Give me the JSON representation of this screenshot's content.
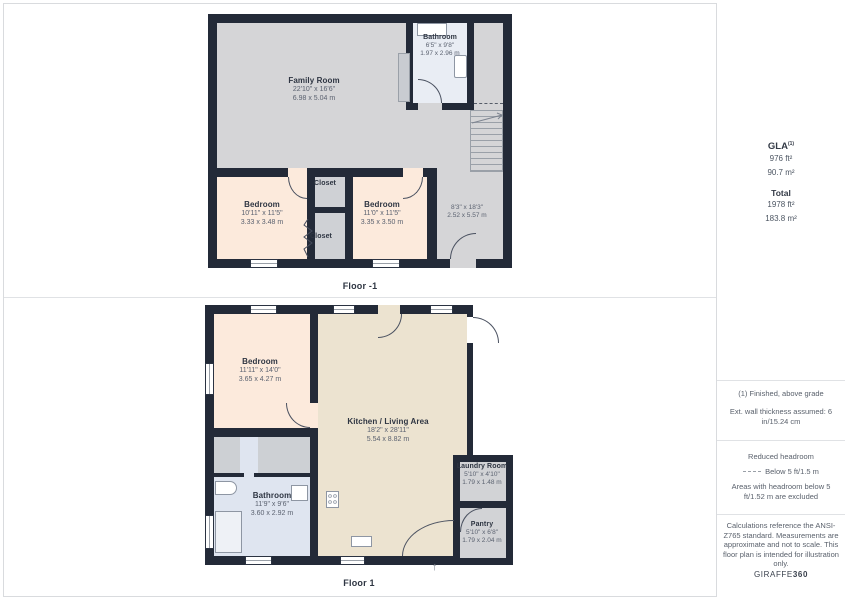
{
  "floors": [
    {
      "label": "Floor -1",
      "rooms": [
        {
          "name": "Family Room",
          "dim_ft": "22'10\" x 16'6\"",
          "dim_m": "6.98 x 5.04 m"
        },
        {
          "name": "Bathroom",
          "dim_ft": "6'5\" x 9'8\"",
          "dim_m": "1.97 x 2.96 m"
        },
        {
          "name": "Bedroom",
          "dim_ft": "10'11\" x 11'5\"",
          "dim_m": "3.33 x 3.48 m"
        },
        {
          "name": "Bedroom",
          "dim_ft": "11'0\" x 11'5\"",
          "dim_m": "3.35 x 3.50 m"
        },
        {
          "name": "Closet"
        },
        {
          "name": "Closet"
        },
        {
          "name": "",
          "dim_ft": "8'3\" x 18'3\"",
          "dim_m": "2.52 x 5.57 m"
        }
      ]
    },
    {
      "label": "Floor 1",
      "rooms": [
        {
          "name": "Bedroom",
          "dim_ft": "11'11\" x 14'0\"",
          "dim_m": "3.65 x 4.27 m"
        },
        {
          "name": "Kitchen / Living Area",
          "dim_ft": "18'2\" x 28'11\"",
          "dim_m": "5.54 x 8.82 m"
        },
        {
          "name": "Bathroom",
          "dim_ft": "11'9\" x 9'6\"",
          "dim_m": "3.60 x 2.92 m"
        },
        {
          "name": "Laundry Room",
          "dim_ft": "5'10\" x 4'10\"",
          "dim_m": "1.79 x 1.48 m"
        },
        {
          "name": "Pantry",
          "dim_ft": "5'10\" x 6'8\"",
          "dim_m": "1.79 x 2.04 m"
        }
      ]
    }
  ],
  "sidebar": {
    "gla": {
      "title": "GLA",
      "superscript": "(1)",
      "ft": "976 ft²",
      "m": "90.7 m²"
    },
    "total": {
      "title": "Total",
      "ft": "1978 ft²",
      "m": "183.8 m²"
    },
    "notes": {
      "finished": "(1) Finished, above grade",
      "wall_thickness": "Ext. wall thickness assumed: 6 in/15.24 cm",
      "reduced_headroom_title": "Reduced headroom",
      "reduced_headroom_legend": "Below 5 ft/1.5 m",
      "headroom_excluded": "Areas with headroom below 5 ft/1.52 m are excluded",
      "disclaimer": "Calculations reference the ANSI-Z765 standard. Measurements are approximate and not to scale. This floor plan is intended for illustration only."
    },
    "brand": {
      "name": "GIRAFFE",
      "suffix": "360"
    }
  },
  "colors": {
    "wall": "#232a38",
    "floor_gray": "#d5d5d7",
    "floor_peach": "#fceadc",
    "floor_bath_upper": "#e9edf4",
    "floor_bath_lower": "#dfe5f0",
    "floor_kitchen": "#ece3d0",
    "floor_closet": "#cfd1d5",
    "divider": "#e0e2e5",
    "label_text": "#2e3542",
    "dim_text": "#5b6270"
  }
}
